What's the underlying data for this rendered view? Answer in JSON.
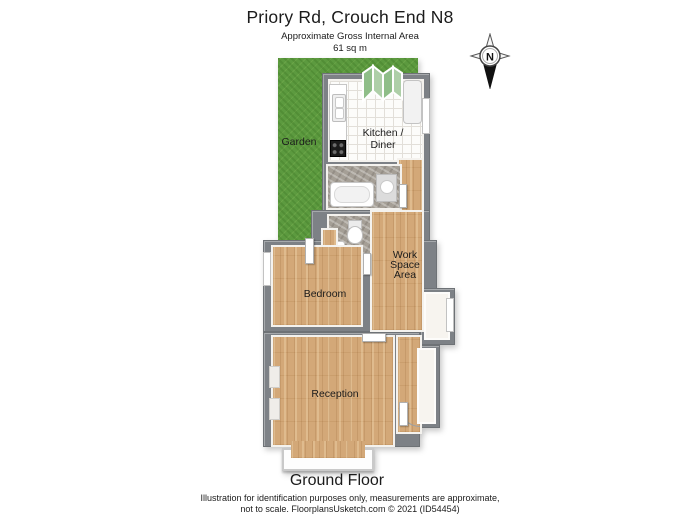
{
  "header": {
    "title": "Priory Rd, Crouch End N8",
    "subtitle": "Approximate Gross Internal Area",
    "area": "61 sq m"
  },
  "compass": {
    "north_label": "N"
  },
  "rooms": {
    "garden": {
      "label": "Garden"
    },
    "kitchen": {
      "line1": "Kitchen /",
      "line2": "Diner"
    },
    "bedroom": {
      "label": "Bedroom"
    },
    "workspace": {
      "line1": "Work",
      "line2": "Space",
      "line3": "Area"
    },
    "reception": {
      "label": "Reception"
    }
  },
  "footer": {
    "floor_label": "Ground Floor",
    "disclaimer_line1": "Illustration for identification purposes only, measurements are approximate,",
    "disclaimer_line2": "not to scale. FloorplansUsketch.com © 2021 (ID54454)"
  },
  "icons": {
    "compass": "compass-rose-north-icon",
    "bifold_door": "bifold-garden-door-icon",
    "bathtub": "bathtub-icon",
    "toilet": "toilet-icon",
    "sink": "kitchen-sink-icon",
    "cooktop": "cooktop-icon",
    "fridge": "fridge-icon"
  },
  "colors": {
    "garden_green": "#5c9a3f",
    "wall_gray": "#7d8186",
    "wood_floor": "#d3a878",
    "stone_floor": "#a59f96",
    "door_glass_green": "#8fbe88"
  }
}
